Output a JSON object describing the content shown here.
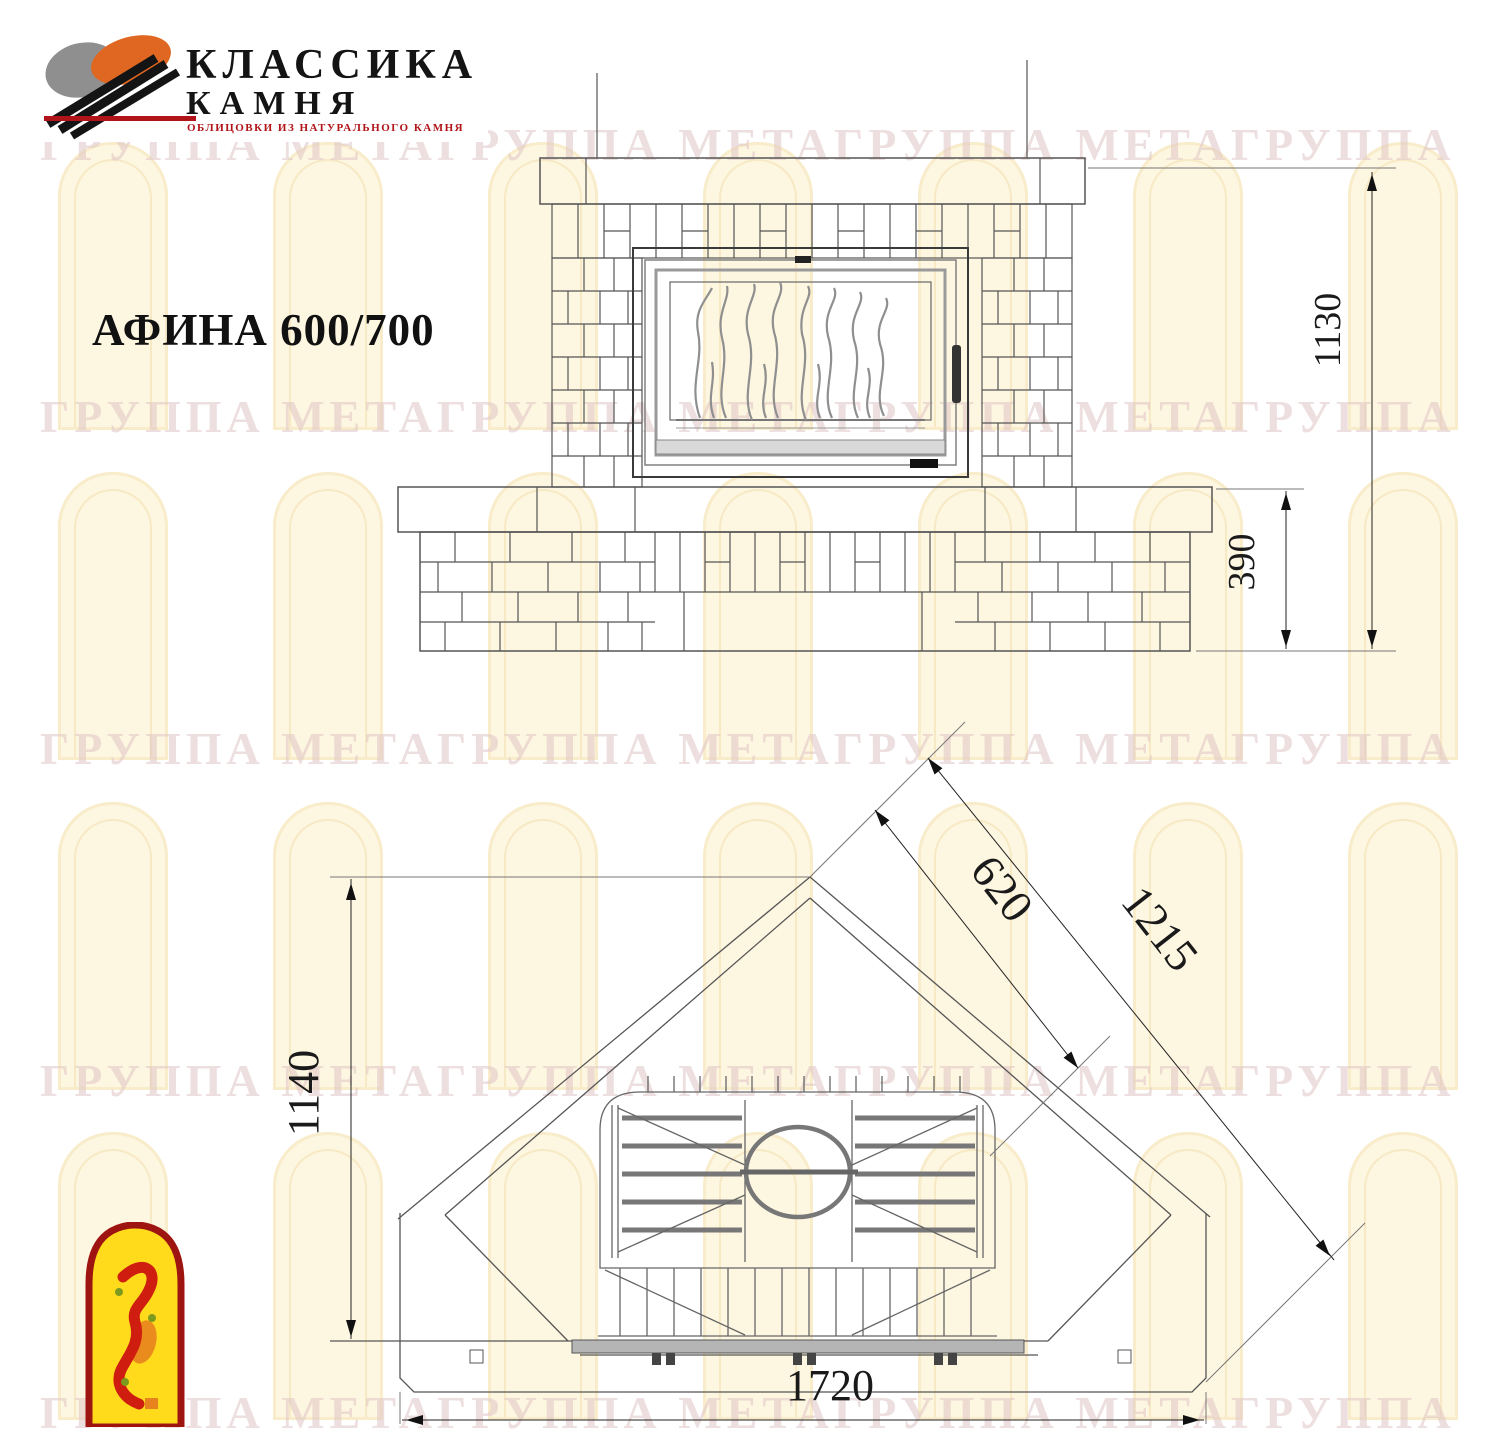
{
  "page": {
    "frame_color": "#f6c75f",
    "background": "#ffffff",
    "line_color": "#555555"
  },
  "logo": {
    "line1": "КЛАССИКА",
    "line2": "КАМНЯ",
    "subtitle": "ОБЛИЦОВКИ ИЗ НАТУРАЛЬНОГО КАМНЯ",
    "colors": {
      "orange": "#e06721",
      "gray": "#8f8f8f",
      "black": "#141414",
      "red": "#b01418"
    }
  },
  "title": "АФИНА 600/700",
  "watermark": {
    "text": "ГРУППА МЕТАГРУППА МЕТАГРУППА МЕТАГРУППА МЕТАГРУППА МЕТА",
    "arch_fill": "#fdf6e1",
    "arch_border": "#f8ecca",
    "text_color": "#e0c6c6"
  },
  "drawing": {
    "product": "АФИНА 600/700",
    "views": [
      "front elevation",
      "plan view"
    ],
    "dims": {
      "front_height": "1130",
      "bench_height": "390",
      "firebox_front": "620",
      "bench_front": "1215",
      "depth": "1140",
      "total_width": "1720"
    }
  },
  "corner_logo": {
    "border": "#9e1410",
    "fill": "#ffdb1c",
    "figure_red": "#cf1d10",
    "figure_orange": "#e8821e",
    "dot_green": "#7c9a1e"
  }
}
